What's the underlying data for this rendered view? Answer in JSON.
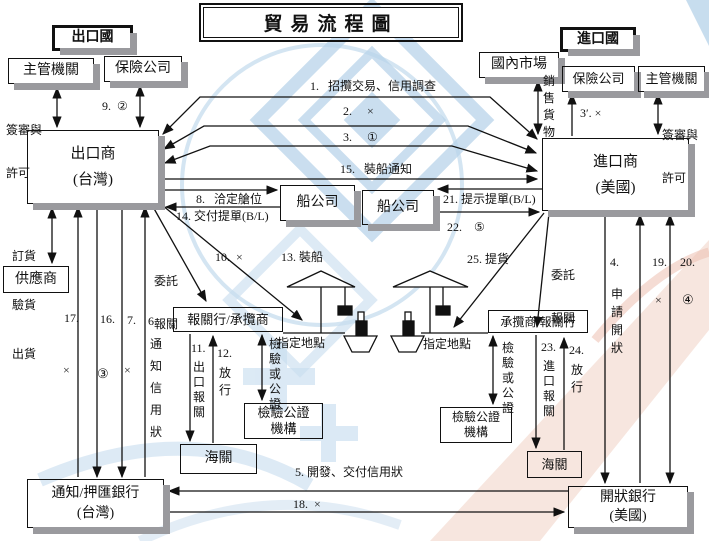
{
  "title": "貿易流程圖",
  "countries": {
    "export": "出口國",
    "import": "進口國"
  },
  "boxes": {
    "authority_left": "主管機關",
    "insurance_left": "保險公司",
    "domestic_market": "國內市場",
    "insurance_right": "保險公司",
    "authority_right": "主管機關",
    "exporter": {
      "line1": "出口商",
      "line2": "(台灣)"
    },
    "importer": {
      "line1": "進口商",
      "line2": "(美國)"
    },
    "shipping_left": "船公司",
    "shipping_right": "船公司",
    "supplier": "供應商",
    "broker_left": "報關行/承攬商",
    "broker_right": "承攬商/報關行",
    "inspection_left": {
      "line1": "檢驗公證",
      "line2": "機構"
    },
    "inspection_right": {
      "line1": "檢驗公證",
      "line2": "機構"
    },
    "customs_left": "海關",
    "customs_right": "海關",
    "bank_left": {
      "line1": "通知/押匯銀行",
      "line2": "(台灣)"
    },
    "bank_right": {
      "line1": "開狀銀行",
      "line2": "(美國)"
    }
  },
  "steps": {
    "s1": "1.   招攬交易、信用調查",
    "s2": "2.     ×",
    "s3": "3.     ①",
    "s3p": "3′. ×",
    "s4": "4.",
    "s4_text": "申請開狀",
    "s5": "5. 開發、交付信用狀",
    "s6": "6.",
    "s6_text": "通知信用狀",
    "s7": "7.",
    "s7_mark": "×",
    "s8": "8.   洽定艙位",
    "s9": "9.  ②",
    "s10": "10.  ×",
    "s11": "11.",
    "s11_text": "出口報關",
    "s12": "12.",
    "s12_text": "放行",
    "s13": "13. 裝船",
    "s14": "14. 交付提單(B/L)",
    "s15": "15.   裝船通知",
    "s16": "16.",
    "s16_mark": "③",
    "s17": "17.",
    "s17_mark": "×",
    "s18": "18.  ×",
    "s19": "19.",
    "s19_mark": "×",
    "s20": "20.",
    "s20_mark": "④",
    "s21": "21. 提示提單(B/L)",
    "s22": "22.    ⑤",
    "s23": "23.",
    "s23_text": "進口報關",
    "s24": "24.",
    "s24_text": "放行",
    "s25": "25. 提貨"
  },
  "labels": {
    "license_left": {
      "line1": "簽審與",
      "line2": "許可"
    },
    "license_right": {
      "line1": "簽審與",
      "line2": "許可"
    },
    "sell_goods": "銷售貨物",
    "order_check_ship": {
      "line1": "訂貨",
      "line2": "驗貨",
      "line3": "出貨"
    },
    "entrust_left": {
      "line1": "委託",
      "line2": "報關"
    },
    "entrust_right": {
      "line1": "委託",
      "line2": "報關"
    },
    "inspect_left": "檢驗或公證",
    "inspect_right": "檢驗或公證",
    "designated_left": "指定地點",
    "designated_right": "指定地點"
  },
  "icons": {
    "crane_left": "harbor-crane-icon",
    "crane_right": "harbor-crane-icon",
    "ship_left": "cargo-ship-icon",
    "ship_right": "cargo-ship-icon"
  },
  "colors": {
    "line": "#111111",
    "box_shadow": "#9a9a9e",
    "watermark_blue": "#b9d4ea",
    "watermark_pink": "#f2d6c9"
  }
}
